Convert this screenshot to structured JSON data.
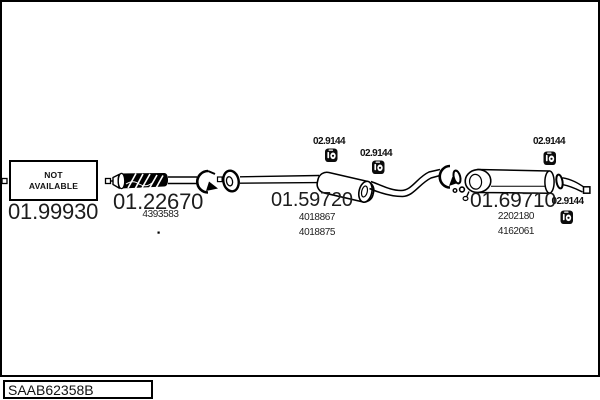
{
  "diagram": {
    "not_available_box": {
      "line1": "NOT",
      "line2": "AVAILABLE"
    },
    "parts": [
      {
        "number": "01.99930",
        "refs": []
      },
      {
        "number": "01.22670",
        "refs": [
          "4393583"
        ]
      },
      {
        "number": "01.59720",
        "refs": [
          "4018867",
          "4018875"
        ]
      },
      {
        "number": "01.69710",
        "refs": [
          "2202180",
          "4162061"
        ]
      }
    ],
    "hangers": [
      {
        "number": "02.9144"
      },
      {
        "number": "02.9144"
      },
      {
        "number": "02.9144"
      },
      {
        "number": "02.9144"
      }
    ],
    "icons": {
      "hanger": "hanger-clamp-icon"
    },
    "colors": {
      "line": "#000000",
      "text": "#1a1a1a",
      "background": "#ffffff"
    }
  },
  "footer": {
    "drawing_code": "SAAB62358B"
  }
}
